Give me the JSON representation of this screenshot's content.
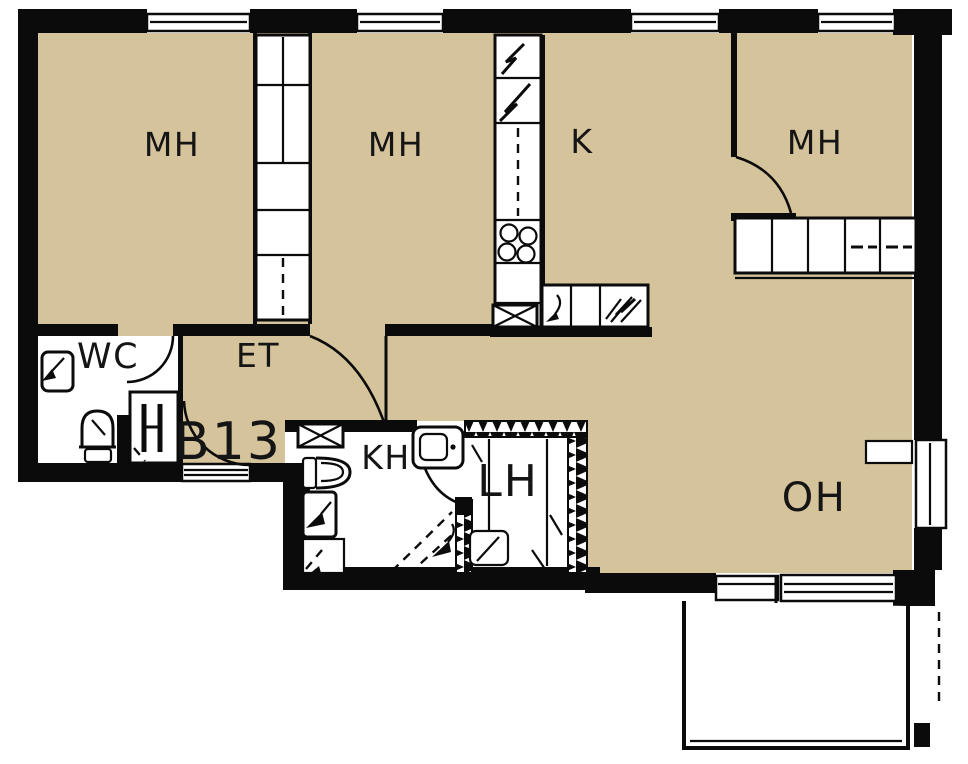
{
  "plan": {
    "apartment_number": "B13",
    "labels": {
      "bedroom_1": "MH",
      "bedroom_2": "MH",
      "bedroom_3": "MH",
      "kitchen": "K",
      "toilet_room": "WC",
      "entry": "ET",
      "bathroom": "KH",
      "sauna": "LH",
      "living_room": "OH"
    },
    "colors": {
      "floor": "#d4c39b",
      "wall": "#0b0b0b",
      "background": "#ffffff"
    },
    "icons": [
      "window",
      "door-swing",
      "wardrobe",
      "fridge-freezer",
      "tall-cabinet",
      "hob",
      "kitchen-sink",
      "dishwasher-reservation",
      "cross-cabinet",
      "toilet",
      "washbasin",
      "washing-machine",
      "appliance-reservation",
      "shower",
      "sauna-stove",
      "sauna-bench",
      "balcony",
      "boundary-line"
    ]
  }
}
